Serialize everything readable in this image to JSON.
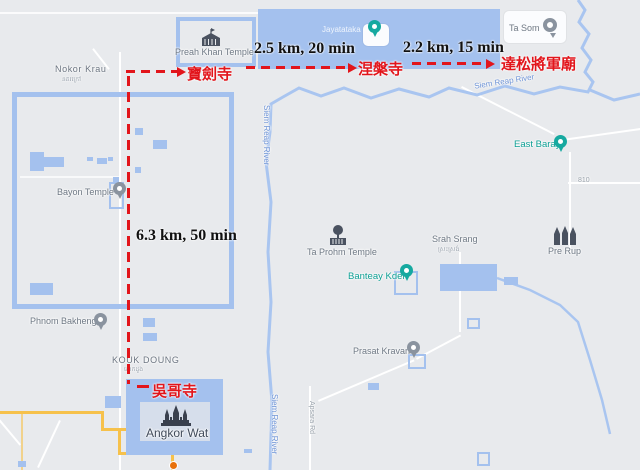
{
  "map": {
    "colors": {
      "background": "#e8eaed",
      "water": "#a4c1ee",
      "yellow_road": "#f6c14b",
      "label_gray": "#6e7884",
      "poi_teal": "#0d9f94",
      "river_label_blue": "#6f94d6",
      "route_red": "#e2151b",
      "distance_text": "#111111"
    },
    "places": {
      "nokor_krau": {
        "name": "Nokor Krau",
        "khmer": "នគរក្រៅ"
      },
      "preah_khan": {
        "name": "Preah Khan Temple",
        "icon": "temple-icon"
      },
      "jayatataka": {
        "name": "Jayatataka",
        "icon": "teal-temple-pin"
      },
      "ta_som": {
        "name": "Ta Som",
        "icon": "ring-pin"
      },
      "bayon": {
        "name": "Bayon Temple",
        "icon": "gray-pin"
      },
      "east_baray": {
        "name": "East Baray",
        "icon": "teal-temple-pin"
      },
      "ta_prohm": {
        "name": "Ta Prohm Temple",
        "icon": "tree-ruin-icon"
      },
      "srah_srang": {
        "name": "Srah Srang",
        "khmer": "ស្រះស្រង់"
      },
      "banteay_kdei": {
        "name": "Banteay Kdei",
        "icon": "teal-temple-pin"
      },
      "pre_rup": {
        "name": "Pre Rup",
        "icon": "towers-icon"
      },
      "phnom_bakheng": {
        "name": "Phnom Bakheng",
        "icon": "gray-pin"
      },
      "kouk_doung": {
        "name": "KOUK DOUNG",
        "khmer": "គោកដូង"
      },
      "angkor_wat": {
        "name": "Angkor Wat",
        "icon": "angkor-wat-icon"
      },
      "prasat_kravan": {
        "name": "Prasat Kravan",
        "icon": "gray-pin"
      },
      "siem_reap_river": {
        "name": "Siem Reap River"
      },
      "apsara_rd": {
        "name": "Apsara Rd"
      },
      "road_810": {
        "name": "810"
      }
    }
  },
  "route": {
    "color": "#e2151b",
    "stops": [
      {
        "label": "寶劍寺"
      },
      {
        "label": "涅槃寺"
      },
      {
        "label": "達松將軍廟"
      },
      {
        "label": "吳哥寺"
      }
    ],
    "legs": [
      {
        "annotation": "2.5 km, 20 min"
      },
      {
        "annotation": "2.2 km, 15 min"
      },
      {
        "annotation": "6.3 km, 50 min"
      }
    ]
  }
}
